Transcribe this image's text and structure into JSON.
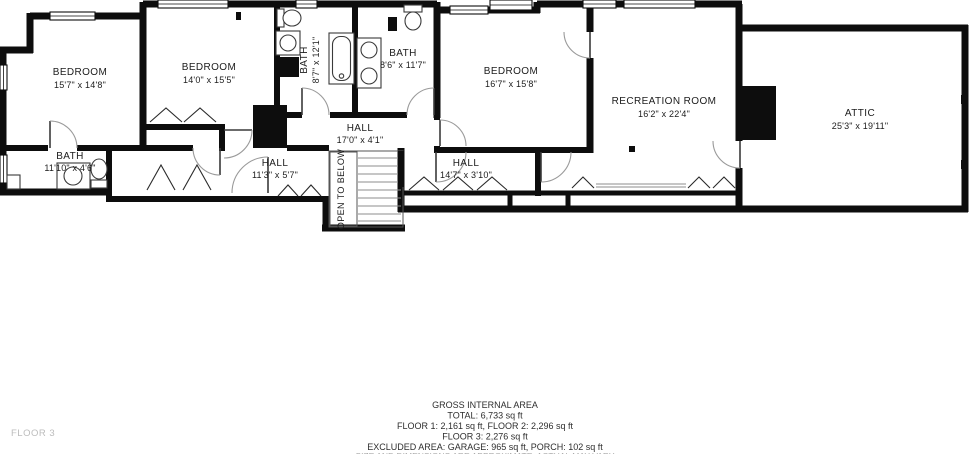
{
  "floor_label": "FLOOR 3",
  "rooms": {
    "bedroom1": {
      "name": "BEDROOM",
      "dims": "15'7\" x 14'8\""
    },
    "bedroom2": {
      "name": "BEDROOM",
      "dims": "14'0\" x 15'5\""
    },
    "bedroom3": {
      "name": "BEDROOM",
      "dims": "16'7\" x 15'8\""
    },
    "bath1": {
      "name": "BATH",
      "dims": "11'10\" x 4'6\""
    },
    "bath2": {
      "name": "BATH",
      "dims": "8'7\" x 12'1\""
    },
    "bath3": {
      "name": "BATH",
      "dims": "8'6\" x 11'7\""
    },
    "recreation": {
      "name": "RECREATION ROOM",
      "dims": "16'2\" x 22'4\""
    },
    "attic": {
      "name": "ATTIC",
      "dims": "25'3\" x 19'11\""
    },
    "hall1": {
      "name": "HALL",
      "dims": "17'0\" x 4'1\""
    },
    "hall2": {
      "name": "HALL",
      "dims": "11'3\" x 5'7\""
    },
    "hall3": {
      "name": "HALL",
      "dims": "14'7\" x 3'10\""
    },
    "stairs": {
      "label": "OPEN TO BELOW"
    }
  },
  "footer": {
    "line1": "GROSS INTERNAL AREA",
    "line2": "TOTAL: 6,733 sq ft",
    "line3": "FLOOR 1: 2,161 sq ft, FLOOR 2: 2,296 sq ft",
    "line4": "FLOOR 3: 2,276 sq ft",
    "line5": "EXCLUDED AREA: GARAGE: 965 sq ft, PORCH: 102 sq ft",
    "line6": "SIZE AND DIMENSIONS ARE APPROXIMATE, ACTUAL MAY VARY"
  },
  "colors": {
    "wall": "#0d0d0d",
    "text": "#1c1c1c",
    "muted": "#bcbcbc"
  }
}
